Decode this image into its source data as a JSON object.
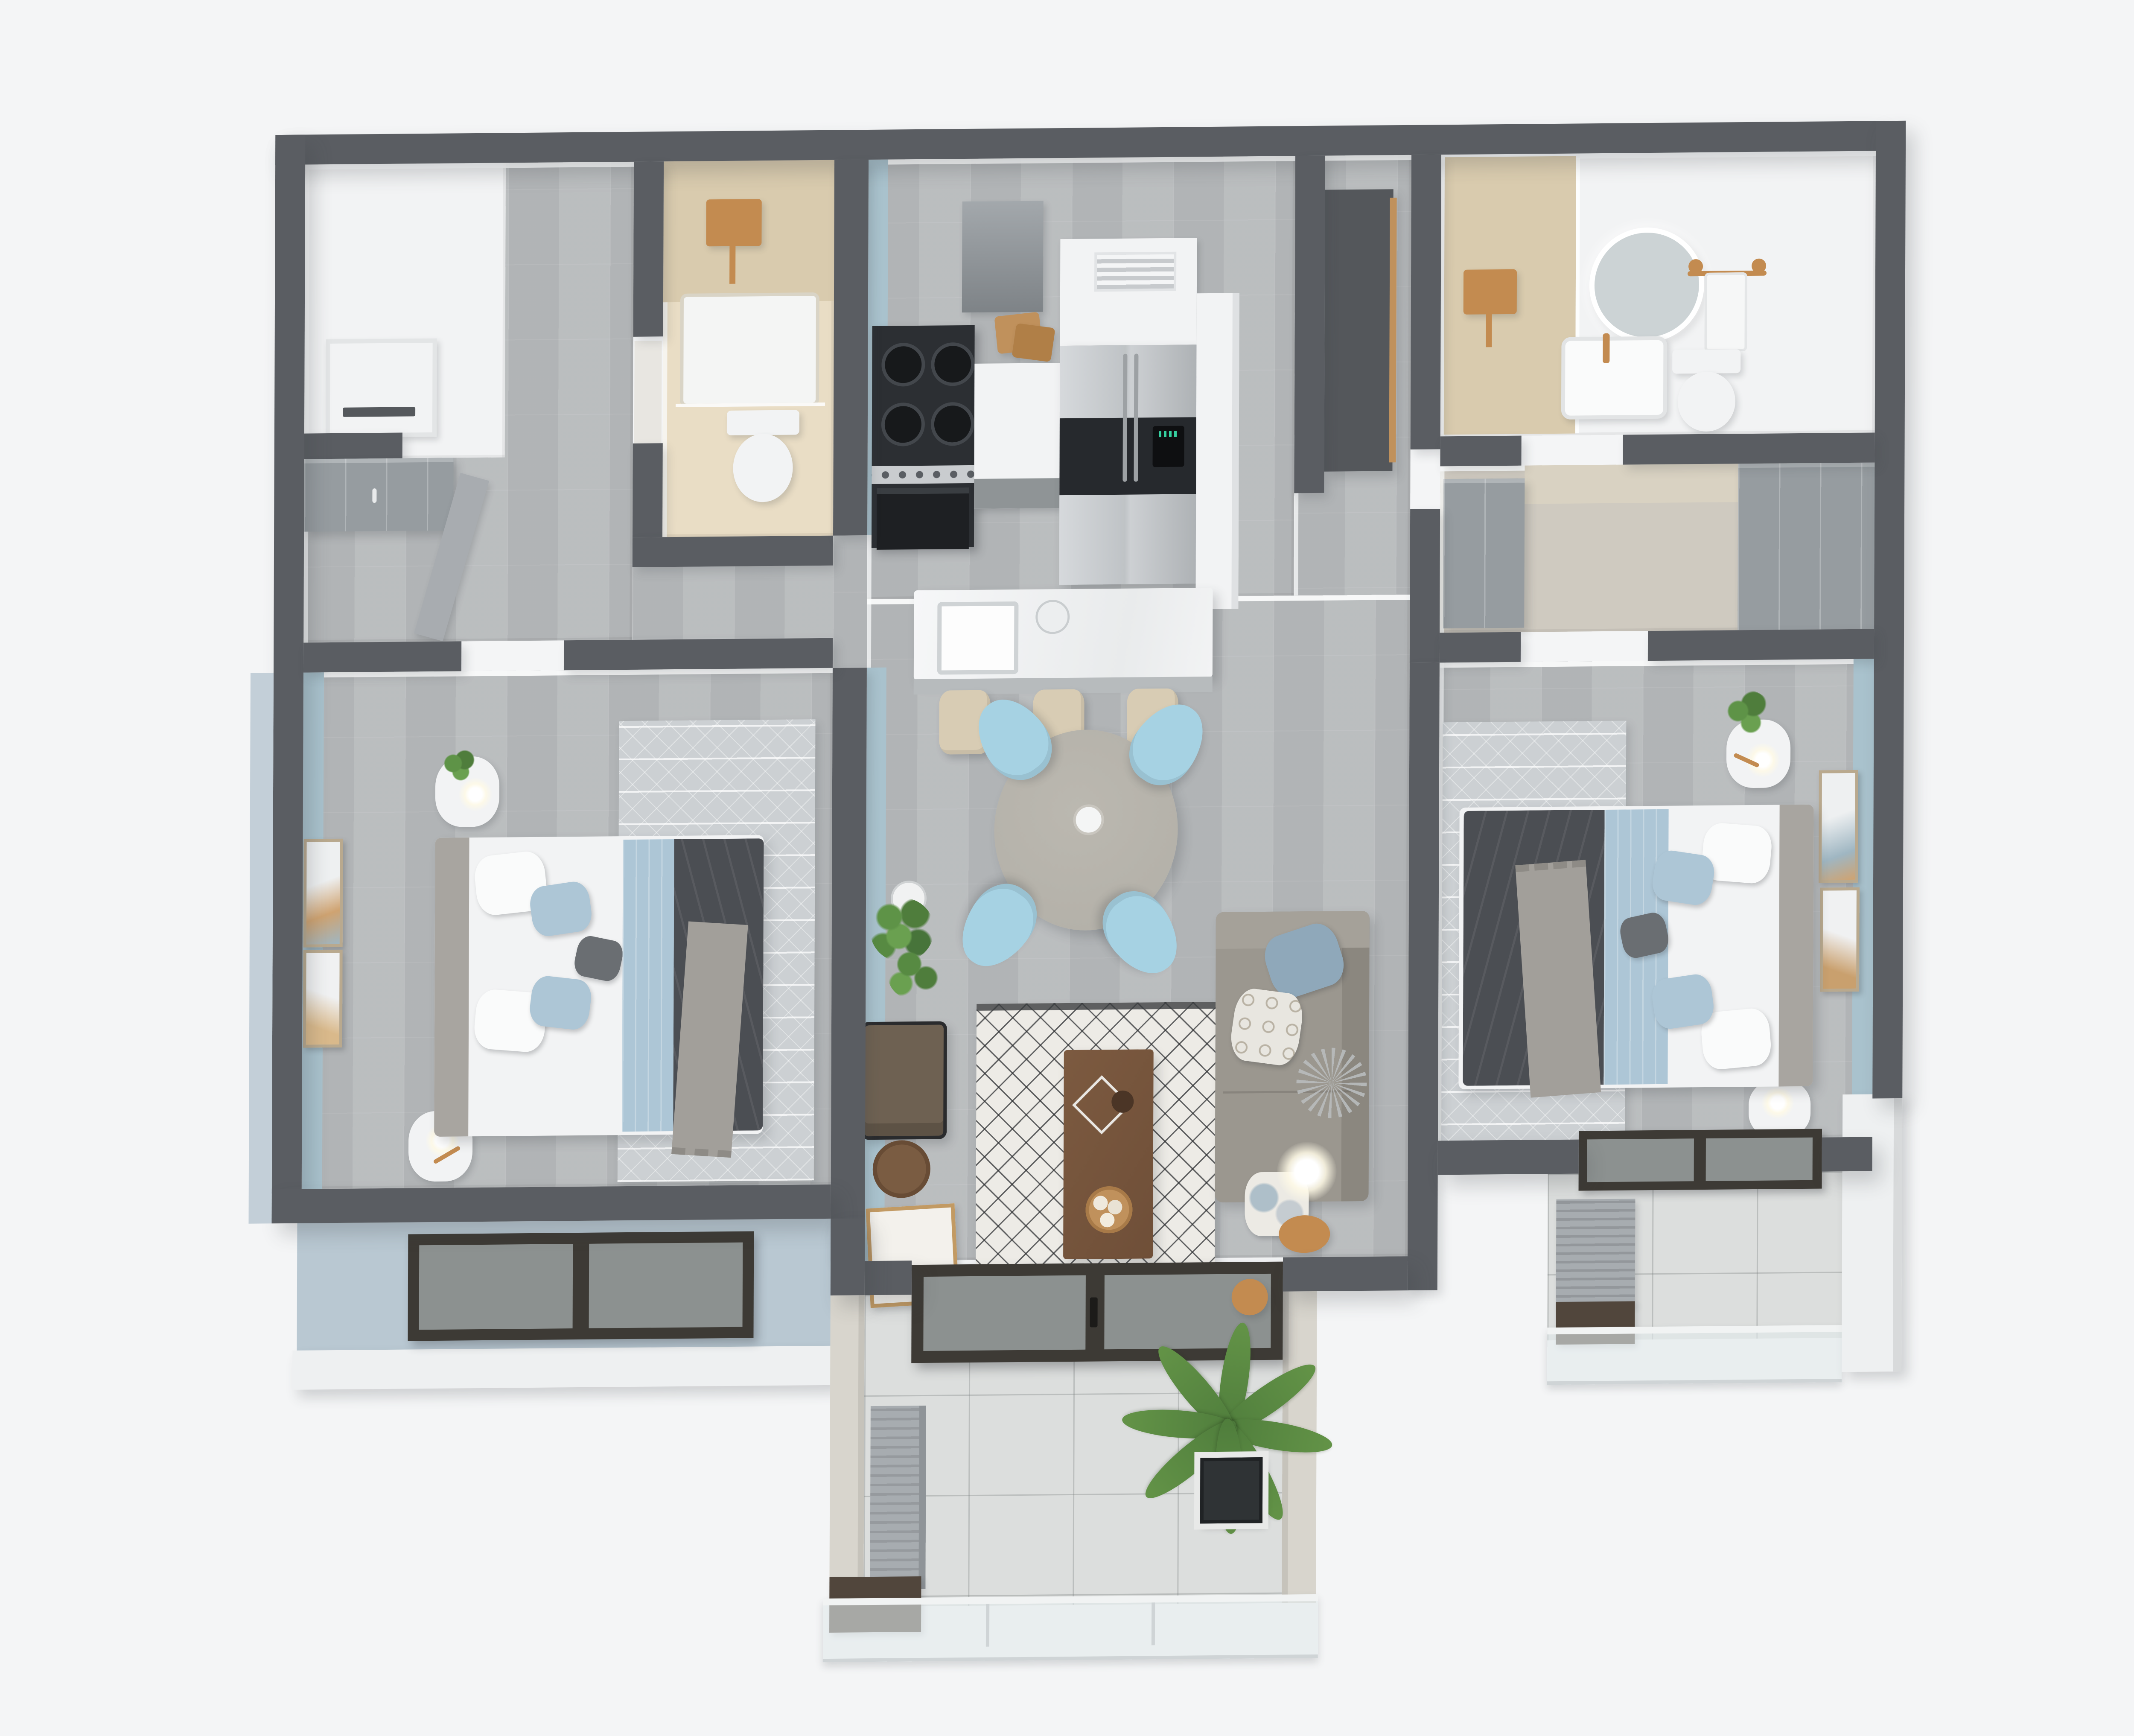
{
  "scene": {
    "title": "3D apartment floor plan render",
    "view": "top-down axonometric cutaway",
    "background": "#f4f5f6",
    "visible_text": ""
  },
  "palette": {
    "wall": "#5a5d62",
    "floorWood": "#b7babc",
    "accentBlue": "#a9c2cd",
    "facadeBlue": "#b9c8d2",
    "beigeWall": "#e9ddc5",
    "tan": "#d9cbae",
    "white": "#f2f3f4",
    "stainless": "#c6c9cc",
    "appliance": "#2c2f33",
    "stool": "#d8ccb4",
    "tableTaupe": "#b2afa7",
    "chairBlue": "#a6d2e3",
    "sofa": "#9b978f",
    "pillowBlue": "#8fa8ba",
    "rugLight": "#edebe6",
    "rugDark": "#3a3c3f",
    "blanketBlue": "#adc6d6",
    "duvetDark": "#4b4e53",
    "throwGray": "#a29f9a",
    "bedroomRug": "#ccd0d3",
    "wood": "#6f4f38",
    "woodLight": "#c0915c",
    "leaf": "#4f7d3c",
    "leafLight": "#639347",
    "gold": "#c38b50",
    "doorFrame": "#3d3a35",
    "cabinetGray": "#969ca0",
    "tile": "#dcdedd"
  },
  "rooms": [
    {
      "id": "entry-hall",
      "name": "Entry hall",
      "furniture": [
        "built-in closet",
        "wall niche",
        "gray wardrobe",
        "open interior door"
      ]
    },
    {
      "id": "bathroom-2",
      "name": "Guest bathroom",
      "wall_color": "#e9ddc5",
      "furniture": [
        "gold rain shower",
        "shower tray",
        "glass screen",
        "toilet",
        "white door"
      ]
    },
    {
      "id": "kitchen",
      "name": "Kitchen",
      "accent_wall": "#a9c2cd",
      "furniture": [
        "range hood",
        "gas stove with oven",
        "cutting boards",
        "counter",
        "side-by-side fridge",
        "vent cabinet",
        "island with sink",
        "3 beige bar stools"
      ]
    },
    {
      "id": "hallway",
      "name": "Hallway",
      "furniture": [
        "tall pantry cabinet"
      ]
    },
    {
      "id": "bathroom-1",
      "name": "Master bathroom",
      "furniture": [
        "gold rain shower",
        "round LED mirror",
        "vanity sink with gold faucet",
        "gold towel rack with towel",
        "toilet"
      ]
    },
    {
      "id": "walk-in-closet",
      "name": "Walk-in closet",
      "furniture": [
        "gray wardrobe left",
        "gray wardrobe right"
      ]
    },
    {
      "id": "bedroom-1",
      "name": "Bedroom left",
      "accent_wall": "#a9c2cd",
      "furniture": [
        "double bed",
        "white pillows",
        "blue pillows",
        "blue blanket",
        "dark duvet",
        "gray throw",
        "2 nightstands",
        "table lamps",
        "2 wall frames",
        "area rug",
        "window"
      ]
    },
    {
      "id": "living-dining",
      "name": "Living / dining room",
      "furniture": [
        "round dining table",
        "4 light-blue chairs",
        "potted plant",
        "geometric rug",
        "wood coffee table",
        "wire basket",
        "vase",
        "fruit bowl",
        "leather lounge chair",
        "round side table",
        "leaning artwork",
        "gray sectional sofa",
        "cushions",
        "floor lamp",
        "sliding glass door"
      ]
    },
    {
      "id": "bedroom-2",
      "name": "Bedroom right",
      "accent_wall": "#a9c2cd",
      "furniture": [
        "double bed",
        "pillows",
        "blue blanket",
        "dark duvet",
        "gray throw",
        "2 nightstands",
        "plant",
        "2 wall frames",
        "area rug",
        "window"
      ]
    },
    {
      "id": "balcony-main",
      "name": "Main balcony",
      "furniture": [
        "large potted palm",
        "AC unit",
        "storage box",
        "glass railing",
        "gold wall sconce"
      ]
    },
    {
      "id": "balcony-bedroom2",
      "name": "Bedroom balcony",
      "furniture": [
        "AC unit",
        "storage box",
        "glass railing"
      ]
    }
  ]
}
